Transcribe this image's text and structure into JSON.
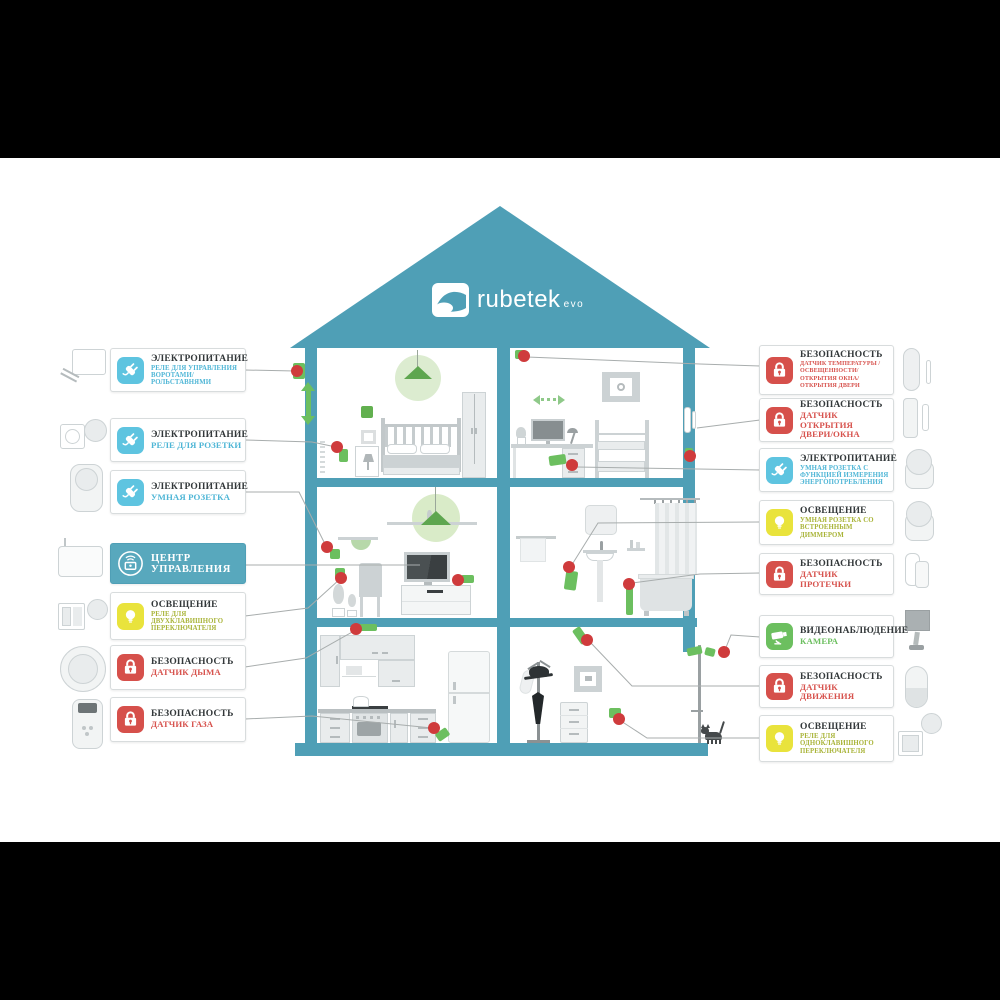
{
  "meta": {
    "brand": "rubetek",
    "edition": "evo"
  },
  "palette": {
    "teal": "#4f9fb6",
    "teal_light": "#58a8bd",
    "electric": "#5ec4e0",
    "security": "#d6504b",
    "lighting": "#e9e33c",
    "video": "#6cbf5f",
    "subtitle_electric": "#4fb6d6",
    "subtitle_security": "#d7534e",
    "subtitle_lighting": "#a9b438",
    "subtitle_video": "#6cbf5f",
    "title_text": "#33383a",
    "connector_line": "#a8adad",
    "marker_dot": "#cf3b3c",
    "accent_green": "#6cbf5f",
    "lamp_glow": "#dcecd0"
  },
  "left_labels": [
    {
      "slug": "gate-shutter-relay",
      "icon": "plug",
      "type": "electric",
      "category": "ЭЛЕКТРОПИТАНИЕ",
      "device": "РЕЛЕ ДЛЯ УПРАВЛЕНИЯ ВОРОТАМИ/РОЛЬСТАВНЯМИ",
      "size": "sm"
    },
    {
      "slug": "socket-relay",
      "icon": "plug",
      "type": "electric",
      "category": "ЭЛЕКТРОПИТАНИЕ",
      "device": "РЕЛЕ ДЛЯ РОЗЕТКИ",
      "size": "lg"
    },
    {
      "slug": "smart-plug",
      "icon": "plug",
      "type": "electric",
      "category": "ЭЛЕКТРОПИТАНИЕ",
      "device": "УМНАЯ РОЗЕТКА",
      "size": "lg"
    },
    {
      "slug": "control-center",
      "icon": "hub",
      "type": "hub",
      "category": "ЦЕНТР УПРАВЛЕНИЯ",
      "device": "",
      "size": "lg"
    },
    {
      "slug": "two-gang-switch-relay",
      "icon": "bulb",
      "type": "lighting",
      "category": "ОСВЕЩЕНИЕ",
      "device": "РЕЛЕ ДЛЯ ДВУХКЛАВИШНОГО ПЕРЕКЛЮЧАТЕЛЯ",
      "size": "sm"
    },
    {
      "slug": "smoke-sensor",
      "icon": "lock",
      "type": "security",
      "category": "БЕЗОПАСНОСТЬ",
      "device": "ДАТЧИК ДЫМА",
      "size": "lg"
    },
    {
      "slug": "gas-sensor",
      "icon": "lock",
      "type": "security",
      "category": "БЕЗОПАСНОСТЬ",
      "device": "ДАТЧИК ГАЗА",
      "size": "lg"
    }
  ],
  "right_labels": [
    {
      "slug": "multi-sensor",
      "icon": "lock",
      "type": "security",
      "category": "БЕЗОПАСНОСТЬ",
      "device": "ДАТЧИК ТЕМПЕРАТУРЫ / ОСВЕЩЕННОСТИ/ ОТКРЫТИЯ ОКНА/ ОТКРЫТИЯ ДВЕРИ",
      "size": "xs"
    },
    {
      "slug": "door-window-sensor",
      "icon": "lock",
      "type": "security",
      "category": "БЕЗОПАСНОСТЬ",
      "device": "ДАТЧИК ОТКРЫТИЯ ДВЕРИ/ОКНА",
      "size": "lg"
    },
    {
      "slug": "energy-meter-plug",
      "icon": "plug",
      "type": "electric",
      "category": "ЭЛЕКТРОПИТАНИЕ",
      "device": "УМНАЯ РОЗЕТКА С ФУНКЦИЕЙ ИЗМЕРЕНИЯ ЭНЕРГОПОТРЕБЛЕНИЯ",
      "size": "sm"
    },
    {
      "slug": "dimmer-plug",
      "icon": "bulb",
      "type": "lighting",
      "category": "ОСВЕЩЕНИЕ",
      "device": "УМНАЯ РОЗЕТКА СО ВСТРОЕННЫМ ДИММЕРОМ",
      "size": "sm"
    },
    {
      "slug": "leak-sensor",
      "icon": "lock",
      "type": "security",
      "category": "БЕЗОПАСНОСТЬ",
      "device": "ДАТЧИК ПРОТЕЧКИ",
      "size": "lg"
    },
    {
      "slug": "camera",
      "icon": "camera",
      "type": "video",
      "category": "ВИДЕОНАБЛЮДЕНИЕ",
      "device": "КАМЕРА",
      "size": "lg"
    },
    {
      "slug": "motion-sensor",
      "icon": "lock",
      "type": "security",
      "category": "БЕЗОПАСНОСТЬ",
      "device": "ДАТЧИК ДВИЖЕНИЯ",
      "size": "lg"
    },
    {
      "slug": "one-gang-switch-relay",
      "icon": "bulb",
      "type": "lighting",
      "category": "ОСВЕЩЕНИЕ",
      "device": "РЕЛЕ ДЛЯ ОДНОКЛАВИШНОГО ПЕРЕКЛЮЧАТЕЛЯ",
      "size": "sm"
    }
  ],
  "house_markers": {
    "dots": [
      [
        297,
        371
      ],
      [
        337,
        447
      ],
      [
        524,
        356
      ],
      [
        572,
        465
      ],
      [
        690,
        456
      ],
      [
        327,
        547
      ],
      [
        341,
        578
      ],
      [
        458,
        580
      ],
      [
        569,
        567
      ],
      [
        629,
        584
      ],
      [
        356,
        629
      ],
      [
        434,
        728
      ],
      [
        587,
        640
      ],
      [
        619,
        719
      ],
      [
        724,
        652
      ]
    ],
    "chips": [
      [
        293,
        363,
        12,
        16,
        0
      ],
      [
        339,
        449,
        9,
        13,
        0
      ],
      [
        515,
        350,
        10,
        9,
        0
      ],
      [
        549,
        455,
        17,
        10,
        -8
      ],
      [
        685,
        448,
        8,
        13,
        0
      ],
      [
        330,
        549,
        10,
        10,
        0
      ],
      [
        335,
        568,
        10,
        10,
        0
      ],
      [
        461,
        575,
        13,
        8,
        0
      ],
      [
        565,
        571,
        12,
        19,
        8
      ],
      [
        626,
        585,
        7,
        30,
        0
      ],
      [
        359,
        624,
        18,
        7,
        0
      ],
      [
        436,
        730,
        13,
        9,
        -35
      ],
      [
        576,
        627,
        9,
        17,
        -35
      ],
      [
        609,
        708,
        12,
        10,
        0
      ],
      [
        687,
        647,
        15,
        8,
        -12
      ],
      [
        705,
        648,
        10,
        8,
        15
      ]
    ]
  },
  "connections": [
    "245,370 295,371",
    "245,440 312,442 336,447",
    "245,492 299,492 326,546",
    "245,565 420,565",
    "245,616 308,608 340,579",
    "245,667 306,658 354,631",
    "245,719 312,716 432,728",
    "760,366 700,364 527,357",
    "760,420 697,428",
    "760,470 577,467",
    "760,522 598,523 573,563",
    "760,573 700,574 632,583",
    "760,637 731,635 725,650",
    "760,686 632,686 590,642",
    "760,738 647,738 621,721"
  ]
}
